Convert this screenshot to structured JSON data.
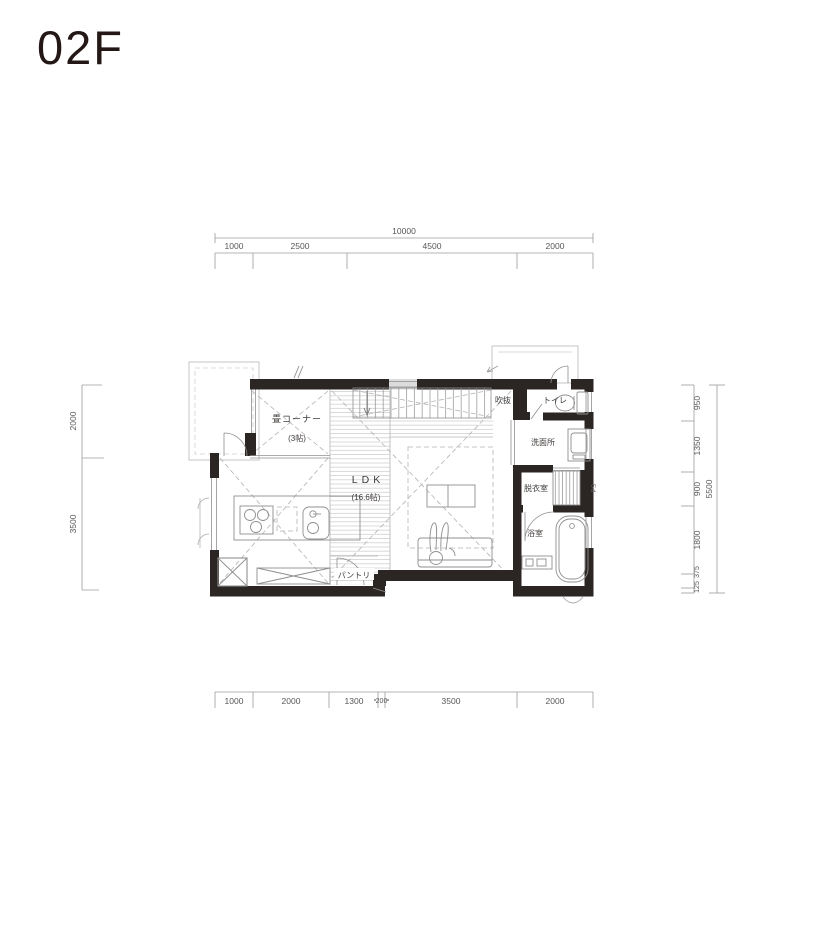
{
  "title": "02F",
  "plan": {
    "rooms": [
      {
        "id": "tatami-corner",
        "label": "畳コーナー",
        "size_label": "(3帖)"
      },
      {
        "id": "ldk",
        "label": "LDK",
        "size_label": "(16.6帖)"
      },
      {
        "id": "void",
        "label": "吹抜"
      },
      {
        "id": "toilet",
        "label": "トイレ"
      },
      {
        "id": "washroom",
        "label": "洗面所"
      },
      {
        "id": "dressing-room",
        "label": "脱衣室"
      },
      {
        "id": "bathroom",
        "label": "浴室"
      },
      {
        "id": "pantry",
        "label": "パントリ"
      },
      {
        "id": "pipe-space",
        "label": "PS"
      }
    ]
  },
  "dimensions": {
    "top": {
      "total": "10000",
      "segments": [
        "1000",
        "2500",
        "4500",
        "2000"
      ]
    },
    "bottom": {
      "segments": [
        "1000",
        "2000",
        "1300",
        "200",
        "3500",
        "2000"
      ]
    },
    "left": {
      "segments": [
        "2000",
        "3500"
      ]
    },
    "right": {
      "total": "5500",
      "segments": [
        "950",
        "1350",
        "900",
        "1800",
        "375",
        "125"
      ]
    }
  },
  "colors": {
    "wall": "#2b2623",
    "dimension_line": "#9b9b9b",
    "dimension_text": "#595757",
    "title_text": "#231815",
    "hatch": "#c9c9c9",
    "dashed_guide": "#b3b3b3"
  }
}
